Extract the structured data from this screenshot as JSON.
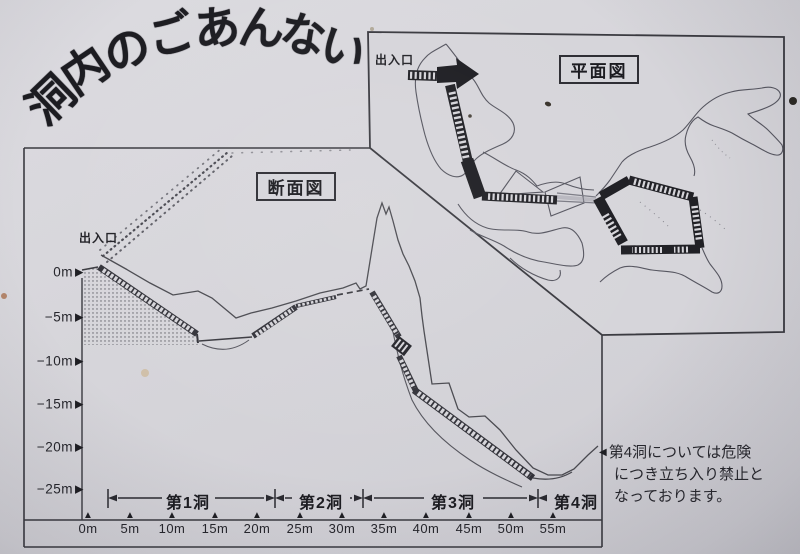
{
  "page": {
    "paper_color": "#d6d5da",
    "ink_color": "#232328"
  },
  "title": {
    "text": "洞内のごあんない",
    "chars": [
      "洞",
      "内",
      "の",
      "ご",
      "あ",
      "ん",
      "な",
      "い"
    ]
  },
  "plan_view": {
    "box_label": "平面図",
    "entrance_label": "出入口"
  },
  "cross_section": {
    "box_label": "断面図",
    "entrance_label": "出入口",
    "depth_labels": [
      "0m",
      "−5m",
      "−10m",
      "−15m",
      "−20m",
      "−25m"
    ],
    "distance_labels": [
      "0m",
      "5m",
      "10m",
      "15m",
      "20m",
      "25m",
      "30m",
      "35m",
      "40m",
      "45m",
      "50m",
      "55m"
    ],
    "cave_spans": [
      {
        "label": "第1洞"
      },
      {
        "label": "第2洞"
      },
      {
        "label": "第3洞"
      },
      {
        "label": "第4洞"
      }
    ]
  },
  "note": {
    "marker": "◀",
    "lines": [
      "第4洞については危険",
      "につき立ち入り禁止と",
      "なっております。"
    ]
  },
  "icons": {
    "triangle_up": "▲",
    "triangle_right": "▶",
    "triangle_left": "◀"
  }
}
